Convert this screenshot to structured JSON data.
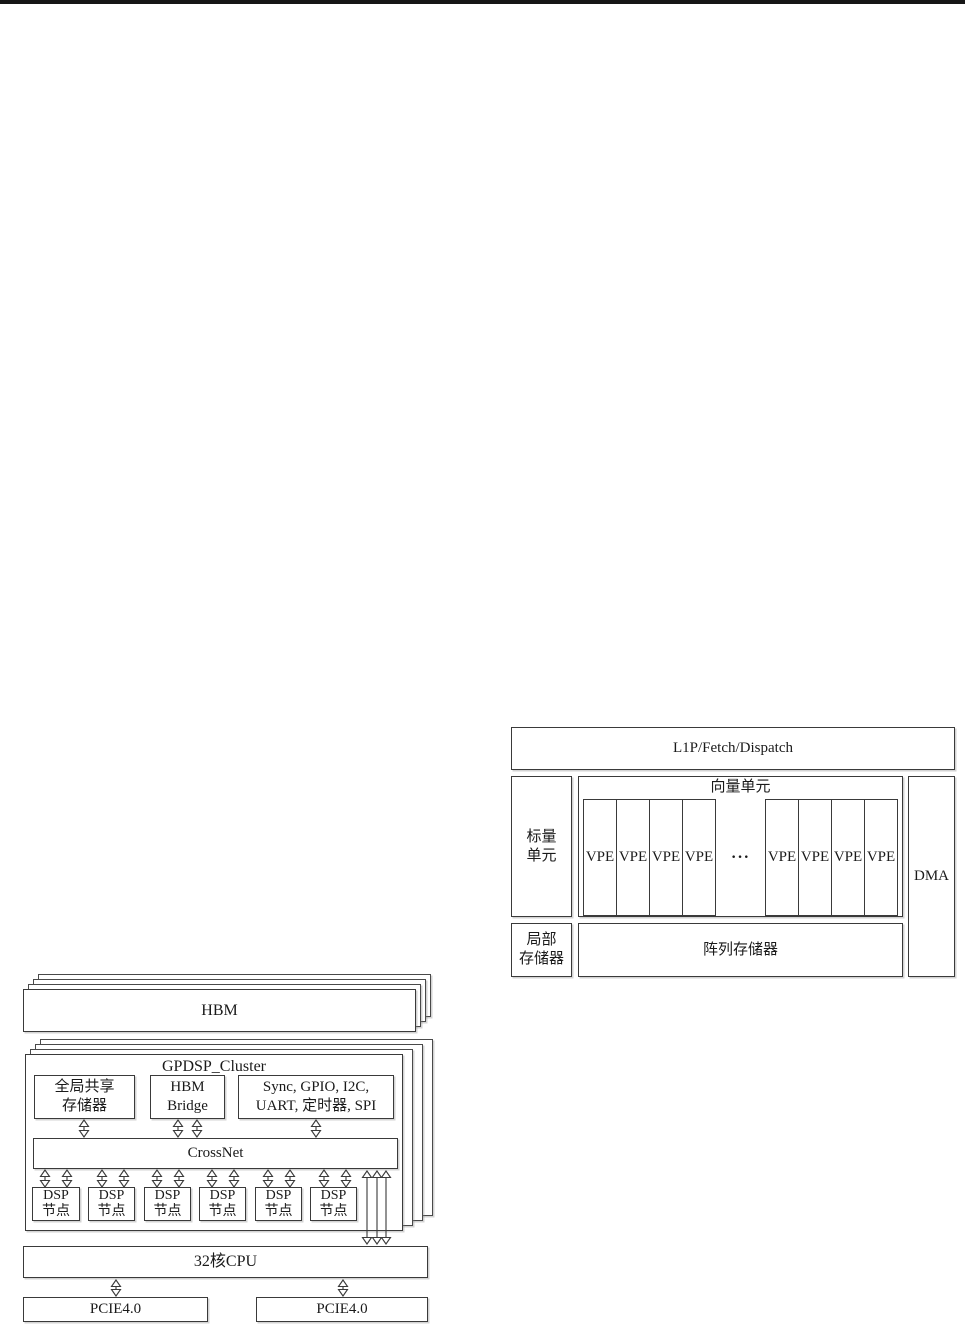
{
  "colors": {
    "line": "#3a3a3a",
    "background": "#ffffff",
    "top_bar": "#161616"
  },
  "core_diagram": {
    "l1p_label": "L1P/Fetch/Dispatch",
    "scalar_unit": {
      "line1": "标量",
      "line2": "单元"
    },
    "vector_unit_label": "向量单元",
    "vpe_label": "VPE",
    "ellipsis": "···",
    "dma_label": "DMA",
    "local_memory": {
      "line1": "局部",
      "line2": "存储器"
    },
    "array_memory_label": "阵列存储器"
  },
  "chip_diagram": {
    "hbm_label": "HBM",
    "cluster_title": "GPDSP_Cluster",
    "global_shared_memory": {
      "line1": "全局共享",
      "line2": "存储器"
    },
    "hbm_bridge": {
      "line1": "HBM",
      "line2": "Bridge"
    },
    "peripherals": {
      "line1": "Sync, GPIO, I2C,",
      "line2": "UART, 定时器, SPI"
    },
    "crossnet_label": "CrossNet",
    "dsp_node": {
      "line1": "DSP",
      "line2": "节点"
    },
    "cpu_label": "32核CPU",
    "pcie_left_label": "PCIE4.0",
    "pcie_right_label": "PCIE4.0"
  }
}
